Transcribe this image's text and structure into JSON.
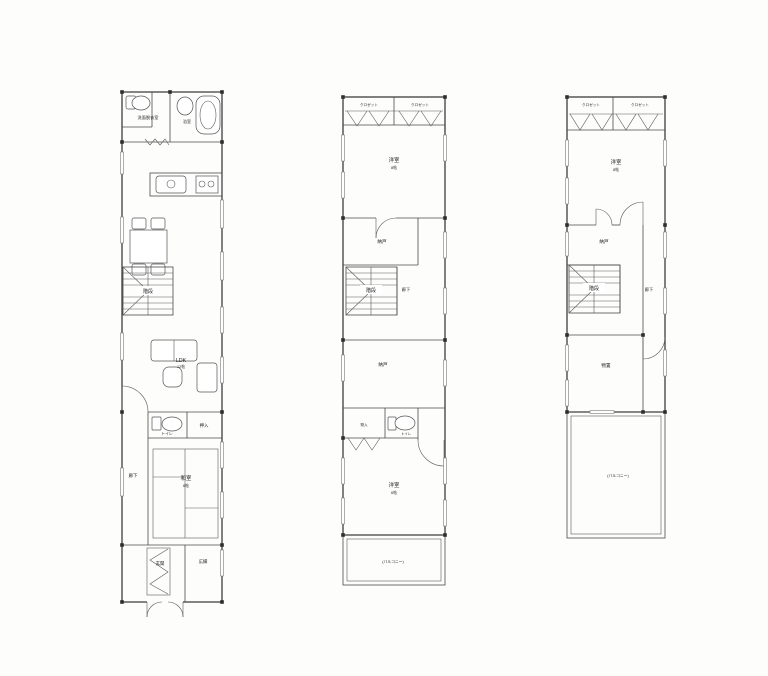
{
  "sheet": {
    "background": "#fdfdfc",
    "line_color": "#3d3d3d",
    "floors": [
      "1F",
      "2F",
      "3F"
    ]
  },
  "f1": {
    "washroom": "洗面脱衣室",
    "bath": "浴室",
    "stairs": "階段",
    "ldk": "LDK",
    "ldk_size": "12帖",
    "toilet": "トイレ",
    "closet": "押入",
    "corridor": "廊下",
    "washitsu": "和室",
    "washitsu_size": "6帖",
    "entrance": "玄関",
    "hiroen": "広縁"
  },
  "f2": {
    "closet_left": "クロゼット",
    "closet_right": "クロゼット",
    "bedroom_top": "洋室",
    "bedroom_top_size": "8帖",
    "nando_upper": "納戸",
    "stairs": "階段",
    "corridor": "廊下",
    "nando_lower": "納戸",
    "closet_small": "物入",
    "toilet": "トイレ",
    "bedroom_bottom": "洋室",
    "bedroom_bottom_size": "6帖",
    "balcony": "(バルコニー)"
  },
  "f3": {
    "closet_left": "クロゼット",
    "closet_right": "クロゼット",
    "bedroom": "洋室",
    "bedroom_size": "8帖",
    "nando": "納戸",
    "stairs": "階段",
    "corridor": "廊下",
    "storage": "物置",
    "balcony": "(バルコニー)"
  }
}
